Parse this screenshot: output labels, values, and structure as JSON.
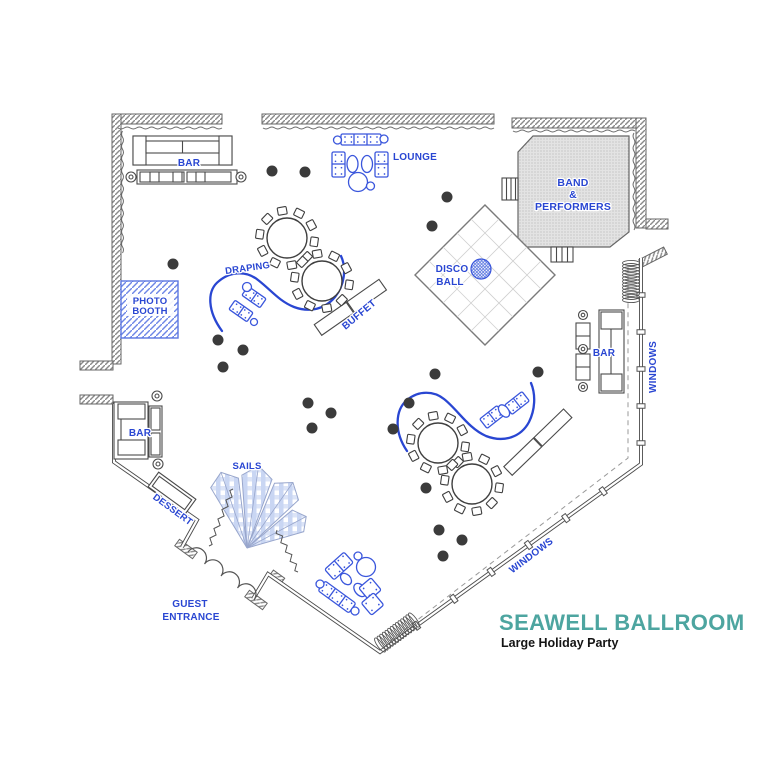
{
  "page": {
    "width": 768,
    "height": 768,
    "background": "#ffffff"
  },
  "colors": {
    "label_blue": "#2946d2",
    "furniture_blue": "#3a56dc",
    "wall_gray": "#555555",
    "hatch_gray": "#8a8a8a",
    "stage_fill": "#e3e3e3",
    "cocktail_dot": "#3b3b3b",
    "sail_check_blue": "#c9d6f3",
    "title_teal": "#4da5a0",
    "subtitle_black": "#141414"
  },
  "title": {
    "text": "SEAWELL BALLROOM",
    "subtitle": "Large Holiday Party"
  },
  "areas": {
    "bar_top": "BAR",
    "bar_left": "BAR",
    "bar_right": "BAR",
    "lounge": "LOUNGE",
    "band_stage": {
      "line1": "BAND",
      "line2": "&",
      "line3": "PERFORMERS"
    },
    "disco_ball": {
      "line1": "DISCO",
      "line2": "BALL"
    },
    "draping": "DRAPING",
    "buffet": "BUFFET",
    "photo_booth": {
      "line1": "PHOTO",
      "line2": "BOOTH"
    },
    "dessert": "DESSERT",
    "sails": "SAILS",
    "guest_entrance": {
      "line1": "GUEST",
      "line2": "ENTRANCE"
    },
    "windows_right": "WINDOWS",
    "windows_bottom": "WINDOWS"
  }
}
